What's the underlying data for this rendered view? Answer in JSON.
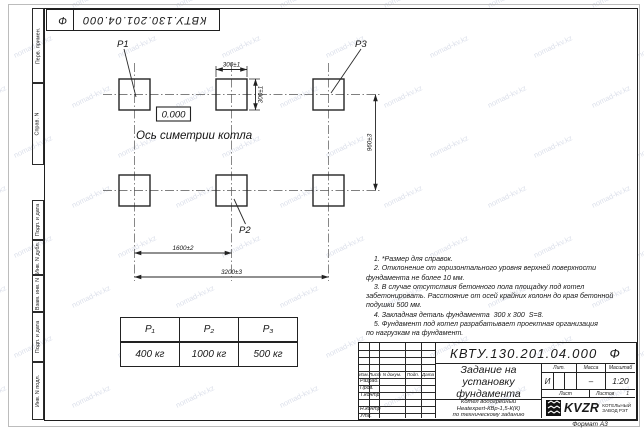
{
  "doc": {
    "designation": "КВТУ.130.201.04.000",
    "designation_suffix": "Ф",
    "format_label": "Формат А3"
  },
  "watermark": {
    "text": "nomad-kv.kz"
  },
  "margin": {
    "labels": [
      "Перв. примен.",
      "Справ. N",
      "Подп. и дата",
      "Инв. N дубл.",
      "Взам. инв. N",
      "Подп. и дата",
      "Инв. N подл."
    ]
  },
  "drawing": {
    "labels": {
      "p1": "P1",
      "p2": "P2",
      "p3": "P3",
      "elevation": "0.000",
      "axis_title": "Ось симетрии котла"
    },
    "dims": {
      "pad_width": "300±1",
      "pad_height": "300±1",
      "row_pitch": "960±3",
      "col_pitch": "1600±2",
      "overall": "3200±3"
    }
  },
  "notes": {
    "lines": [
      "    1. *Размер для справок.",
      "    2. Отклонение от горизонтального уровня верхней поверхности",
      "фундамента не более 10 мм.",
      "    3. В случае отсутствия бетонного пола площадку под котел",
      "забетонировать. Расстояние от осей крайних колонн до края бетонной",
      "подушки 500 мм.",
      "    4. Закладная деталь фундамента  300 х 300  S=8.",
      "    5. Фундамент под котел разрабатывает проектная организация",
      "по нагрузкам на фундамент."
    ]
  },
  "load_table": {
    "headers": [
      "P₁",
      "P₂",
      "P₃"
    ],
    "values": [
      "400 кг",
      "1000 кг",
      "500 кг"
    ]
  },
  "title_block": {
    "rev_header": [
      "Изм.",
      "Лист",
      "N докум.",
      "Подп.",
      "Дата"
    ],
    "sign_labels": [
      "Разраб.",
      "Пров.",
      "Т.контр",
      "",
      "Н.контр",
      "Утв."
    ],
    "title_lines": [
      "Задание на",
      "установку",
      "фундамента"
    ],
    "product_lines": [
      "Котел водогрейный",
      "Heatexpert-КВр-1,5-К(К)",
      "по техническому заданию"
    ],
    "lit_label": "Лит.",
    "mass_label": "Масса",
    "scale_label": "Масштаб",
    "lit_value": "И",
    "mass_value": "–",
    "scale_value": "1:20",
    "sheet_label": "Лист",
    "sheets_label": "Листов",
    "sheets_value": "1",
    "logo_text": "KVZR",
    "company_lines": [
      "КОТЕЛЬНЫЙ",
      "ЗАВОД РЭТ"
    ]
  }
}
